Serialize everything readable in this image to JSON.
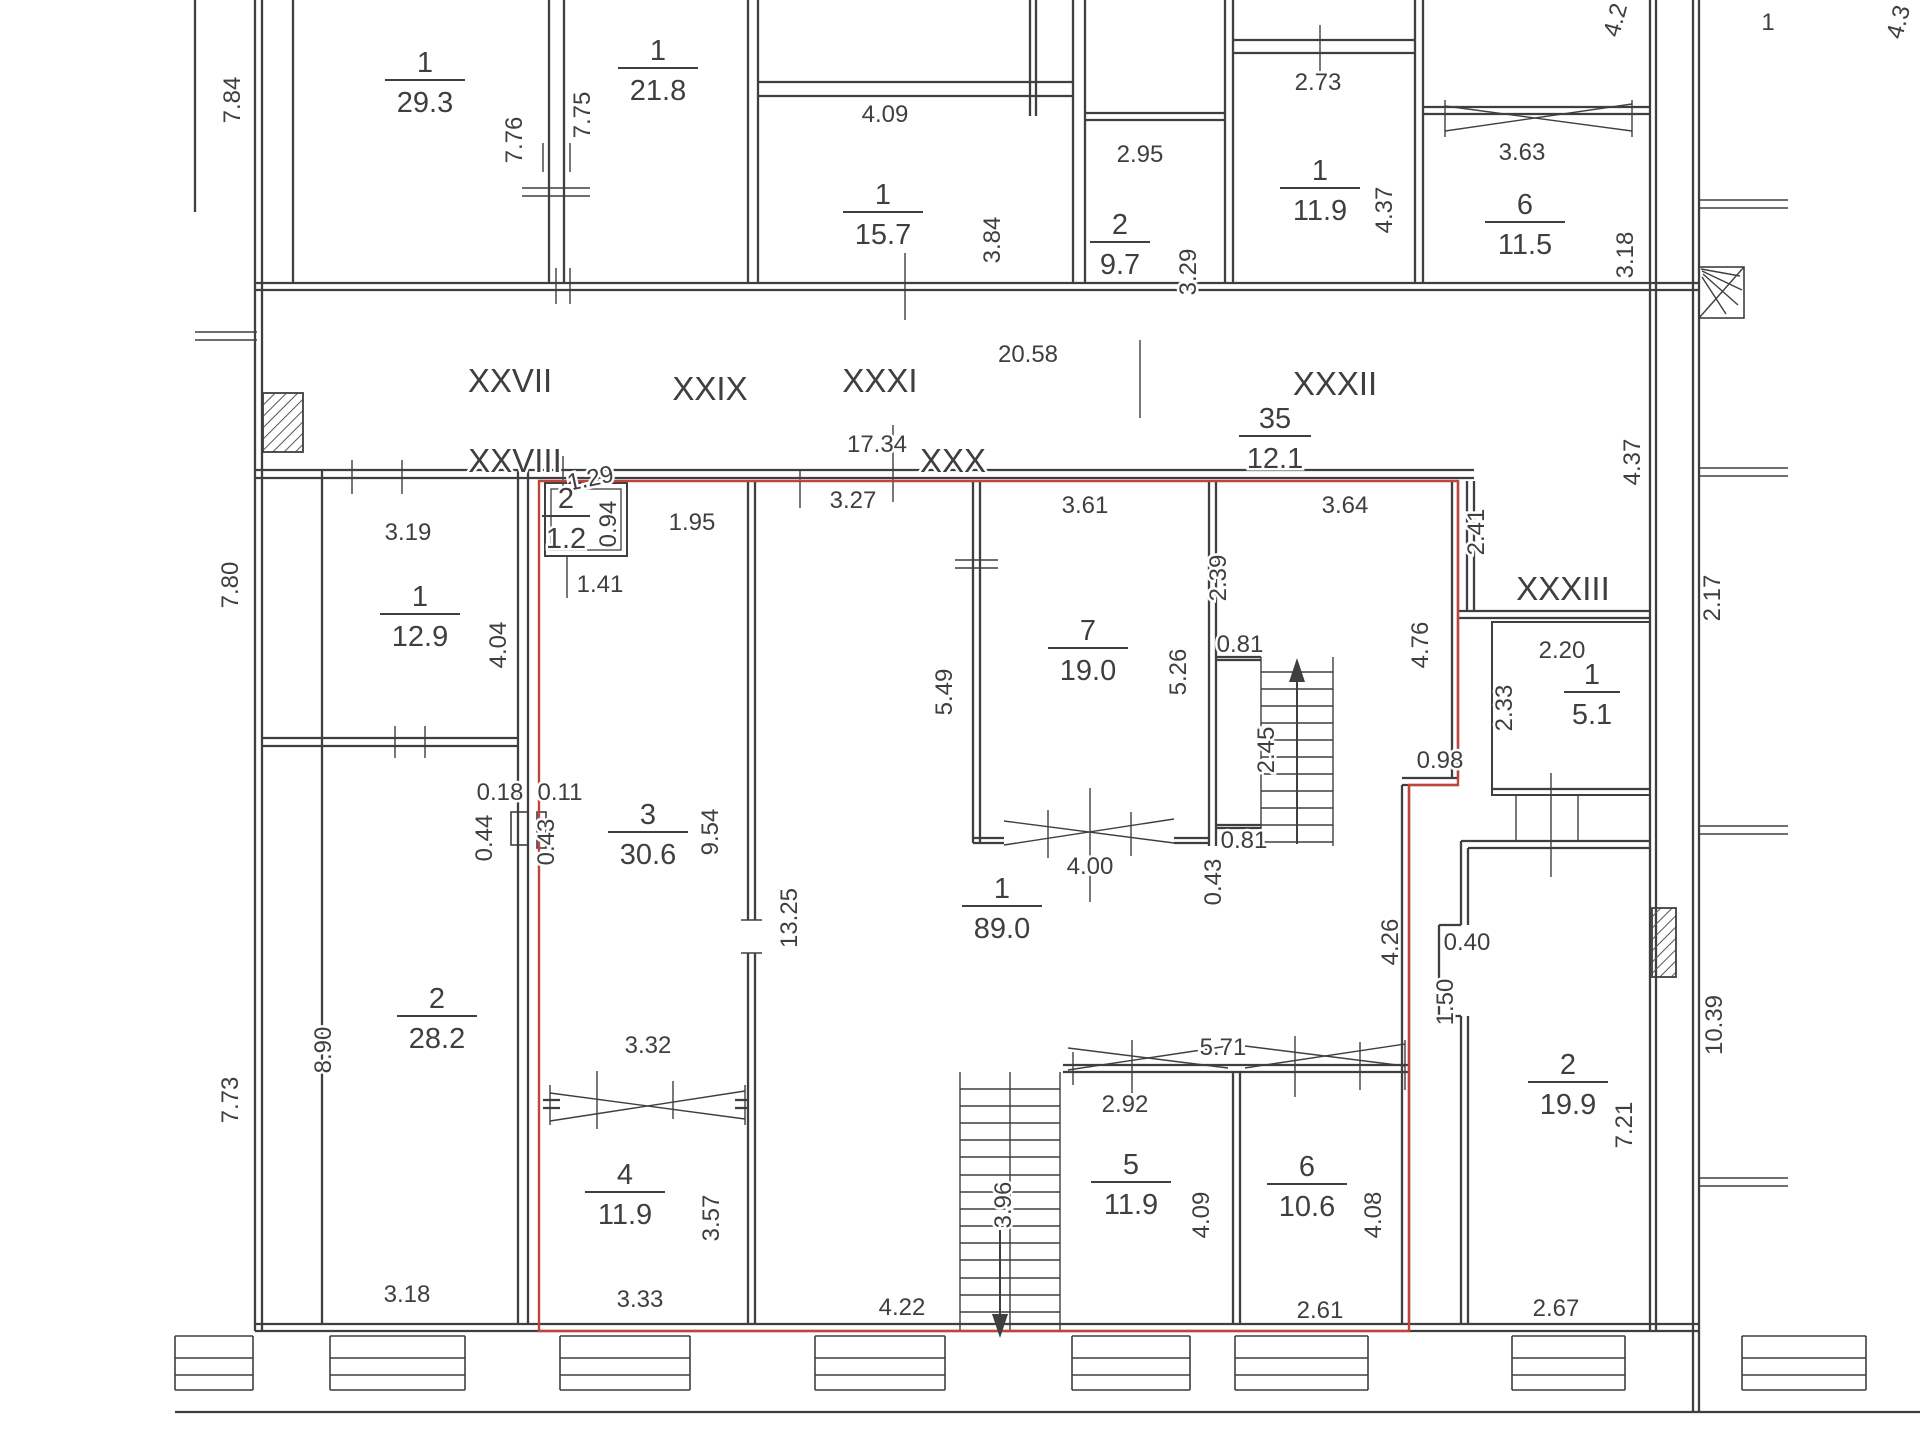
{
  "meta": {
    "title": "Floor plan",
    "ink": "#3f3f3f",
    "red": "#c0443a",
    "background": "#ffffff"
  },
  "rooms": [
    {
      "n": "1",
      "a": "29.3",
      "x": 425,
      "y": 80,
      "w": 40
    },
    {
      "n": "1",
      "a": "21.8",
      "x": 658,
      "y": 68,
      "w": 40
    },
    {
      "n": "1",
      "a": "15.7",
      "x": 883,
      "y": 212,
      "w": 40
    },
    {
      "n": "2",
      "a": "9.7",
      "x": 1120,
      "y": 242,
      "w": 30
    },
    {
      "n": "1",
      "a": "11.9",
      "x": 1320,
      "y": 188,
      "w": 40
    },
    {
      "n": "6",
      "a": "11.5",
      "x": 1525,
      "y": 222,
      "w": 40
    },
    {
      "n": "35",
      "a": "12.1",
      "x": 1275,
      "y": 436,
      "w": 36
    },
    {
      "n": "2",
      "a": "1.2",
      "x": 566,
      "y": 516,
      "w": 24
    },
    {
      "n": "1",
      "a": "12.9",
      "x": 420,
      "y": 614,
      "w": 40
    },
    {
      "n": "7",
      "a": "19.0",
      "x": 1088,
      "y": 648,
      "w": 40
    },
    {
      "n": "1",
      "a": "5.1",
      "x": 1592,
      "y": 692,
      "w": 28
    },
    {
      "n": "3",
      "a": "30.6",
      "x": 648,
      "y": 832,
      "w": 40
    },
    {
      "n": "1",
      "a": "89.0",
      "x": 1002,
      "y": 906,
      "w": 40
    },
    {
      "n": "2",
      "a": "28.2",
      "x": 437,
      "y": 1016,
      "w": 40
    },
    {
      "n": "2",
      "a": "19.9",
      "x": 1568,
      "y": 1082,
      "w": 40
    },
    {
      "n": "4",
      "a": "11.9",
      "x": 625,
      "y": 1192,
      "w": 40
    },
    {
      "n": "5",
      "a": "11.9",
      "x": 1131,
      "y": 1182,
      "w": 40
    },
    {
      "n": "6",
      "a": "10.6",
      "x": 1307,
      "y": 1184,
      "w": 40
    }
  ],
  "labels": [
    {
      "t": "7.84",
      "x": 240,
      "y": 100,
      "r": -90
    },
    {
      "t": "7.76",
      "x": 522,
      "y": 140,
      "r": -90
    },
    {
      "t": "7.75",
      "x": 590,
      "y": 115,
      "r": -90
    },
    {
      "t": "4.09",
      "x": 885,
      "y": 122
    },
    {
      "t": "3.84",
      "x": 1000,
      "y": 240,
      "r": -90
    },
    {
      "t": "2.95",
      "x": 1140,
      "y": 162
    },
    {
      "t": "3.29",
      "x": 1196,
      "y": 272,
      "r": -90
    },
    {
      "t": "2.73",
      "x": 1318,
      "y": 90
    },
    {
      "t": "4.37",
      "x": 1392,
      "y": 210,
      "r": -90
    },
    {
      "t": "3.63",
      "x": 1522,
      "y": 160
    },
    {
      "t": "3.18",
      "x": 1633,
      "y": 255,
      "r": -90
    },
    {
      "t": "4.2",
      "x": 1623,
      "y": 22,
      "r": -75
    },
    {
      "t": "1",
      "x": 1768,
      "y": 30
    },
    {
      "t": "4.3",
      "x": 1906,
      "y": 24,
      "r": -75
    },
    {
      "t": "XXVII",
      "x": 510,
      "y": 392,
      "s": 33
    },
    {
      "t": "XXIX",
      "x": 710,
      "y": 400,
      "s": 33
    },
    {
      "t": "XXXI",
      "x": 880,
      "y": 392,
      "s": 33
    },
    {
      "t": "20.58",
      "x": 1028,
      "y": 362
    },
    {
      "t": "XXXII",
      "x": 1335,
      "y": 395,
      "s": 33
    },
    {
      "t": "XXVIII",
      "x": 515,
      "y": 472,
      "s": 33
    },
    {
      "t": "17.34",
      "x": 877,
      "y": 452
    },
    {
      "t": "XXX",
      "x": 953,
      "y": 472,
      "s": 33
    },
    {
      "t": "XXXIII",
      "x": 1563,
      "y": 600,
      "s": 33
    },
    {
      "t": "3.19",
      "x": 408,
      "y": 540
    },
    {
      "t": "4.04",
      "x": 506,
      "y": 645,
      "r": -90
    },
    {
      "t": "7.80",
      "x": 238,
      "y": 585,
      "r": -90
    },
    {
      "t": "1.29",
      "x": 592,
      "y": 486,
      "r": -12
    },
    {
      "t": "0.94",
      "x": 616,
      "y": 524,
      "r": -90
    },
    {
      "t": "1.41",
      "x": 600,
      "y": 592
    },
    {
      "t": "1.95",
      "x": 692,
      "y": 530
    },
    {
      "t": "3.27",
      "x": 853,
      "y": 508
    },
    {
      "t": "3.61",
      "x": 1085,
      "y": 513
    },
    {
      "t": "3.64",
      "x": 1345,
      "y": 513
    },
    {
      "t": "2.39",
      "x": 1226,
      "y": 578,
      "r": -90
    },
    {
      "t": "5.49",
      "x": 952,
      "y": 692,
      "r": -90
    },
    {
      "t": "5.26",
      "x": 1186,
      "y": 672,
      "r": -90
    },
    {
      "t": "0.81",
      "x": 1240,
      "y": 652
    },
    {
      "t": "2.45",
      "x": 1274,
      "y": 750,
      "r": -90
    },
    {
      "t": "0.81",
      "x": 1244,
      "y": 848
    },
    {
      "t": "4.00",
      "x": 1090,
      "y": 874
    },
    {
      "t": "0.43",
      "x": 1221,
      "y": 882,
      "r": -90
    },
    {
      "t": "2.41",
      "x": 1484,
      "y": 532,
      "r": -90
    },
    {
      "t": "4.76",
      "x": 1428,
      "y": 645,
      "r": -90
    },
    {
      "t": "0.98",
      "x": 1440,
      "y": 768
    },
    {
      "t": "2.20",
      "x": 1562,
      "y": 658
    },
    {
      "t": "2.33",
      "x": 1512,
      "y": 708,
      "r": -90
    },
    {
      "t": "2.17",
      "x": 1720,
      "y": 598,
      "r": -90
    },
    {
      "t": "4.37",
      "x": 1640,
      "y": 462,
      "r": -90
    },
    {
      "t": "0.18",
      "x": 500,
      "y": 800
    },
    {
      "t": "0.11",
      "x": 560,
      "y": 800
    },
    {
      "t": "0.44",
      "x": 492,
      "y": 838,
      "r": -90
    },
    {
      "t": "0.43",
      "x": 554,
      "y": 842,
      "r": -90
    },
    {
      "t": "9.54",
      "x": 718,
      "y": 832,
      "r": -90
    },
    {
      "t": "13.25",
      "x": 797,
      "y": 918,
      "r": -90
    },
    {
      "t": "8.90",
      "x": 331,
      "y": 1050,
      "r": -90
    },
    {
      "t": "7.73",
      "x": 238,
      "y": 1100,
      "r": -90
    },
    {
      "t": "0.40",
      "x": 1467,
      "y": 950
    },
    {
      "t": "1.50",
      "x": 1453,
      "y": 1002,
      "r": -90
    },
    {
      "t": "10.39",
      "x": 1722,
      "y": 1025,
      "r": -90
    },
    {
      "t": "7.21",
      "x": 1632,
      "y": 1125,
      "r": -90
    },
    {
      "t": "4.26",
      "x": 1398,
      "y": 942,
      "r": -90
    },
    {
      "t": "3.32",
      "x": 648,
      "y": 1053
    },
    {
      "t": "3.57",
      "x": 719,
      "y": 1218,
      "r": -90
    },
    {
      "t": "5.71",
      "x": 1223,
      "y": 1055
    },
    {
      "t": "2.92",
      "x": 1125,
      "y": 1112
    },
    {
      "t": "4.09",
      "x": 1209,
      "y": 1215,
      "r": -90
    },
    {
      "t": "4.08",
      "x": 1381,
      "y": 1215,
      "r": -90
    },
    {
      "t": "3.96",
      "x": 1011,
      "y": 1205,
      "r": -90
    },
    {
      "t": "3.18",
      "x": 407,
      "y": 1302
    },
    {
      "t": "3.33",
      "x": 640,
      "y": 1307
    },
    {
      "t": "4.22",
      "x": 902,
      "y": 1315
    },
    {
      "t": "2.61",
      "x": 1320,
      "y": 1318
    },
    {
      "t": "2.67",
      "x": 1556,
      "y": 1316
    }
  ],
  "walls": [
    [
      195,
      0,
      195,
      212
    ],
    [
      255,
      0,
      255,
      1331
    ],
    [
      262,
      0,
      262,
      1331
    ],
    [
      293,
      0,
      293,
      283
    ],
    [
      549,
      0,
      549,
      283
    ],
    [
      564,
      0,
      564,
      283
    ],
    [
      748,
      0,
      748,
      283
    ],
    [
      758,
      0,
      758,
      283
    ],
    [
      1030,
      0,
      1030,
      116
    ],
    [
      1036,
      0,
      1036,
      116
    ],
    [
      1073,
      0,
      1073,
      283
    ],
    [
      1085,
      0,
      1085,
      283
    ],
    [
      1225,
      0,
      1225,
      283
    ],
    [
      1233,
      0,
      1233,
      283
    ],
    [
      1415,
      0,
      1415,
      283
    ],
    [
      1423,
      0,
      1423,
      283
    ],
    [
      1650,
      0,
      1650,
      1331
    ],
    [
      1656,
      0,
      1656,
      1331
    ],
    [
      1693,
      0,
      1693,
      1412
    ],
    [
      1699,
      0,
      1699,
      1412
    ],
    [
      758,
      82,
      1073,
      82
    ],
    [
      758,
      96,
      1073,
      96
    ],
    [
      1085,
      113,
      1225,
      113
    ],
    [
      1085,
      120,
      1225,
      120
    ],
    [
      1233,
      40,
      1415,
      40
    ],
    [
      1233,
      53,
      1415,
      53
    ],
    [
      1423,
      107,
      1650,
      107
    ],
    [
      1423,
      114,
      1650,
      114
    ],
    [
      255,
      283,
      1699,
      283
    ],
    [
      255,
      290,
      1699,
      290
    ],
    [
      255,
      470,
      1474,
      470
    ],
    [
      255,
      478,
      1474,
      478
    ],
    [
      322,
      470,
      322,
      1324
    ],
    [
      518,
      470,
      518,
      1324
    ],
    [
      528,
      470,
      528,
      1324
    ],
    [
      262,
      738,
      518,
      738
    ],
    [
      262,
      746,
      518,
      746
    ],
    [
      255,
      1324,
      1699,
      1324
    ],
    [
      255,
      1331,
      1699,
      1331
    ],
    [
      748,
      481,
      748,
      920
    ],
    [
      748,
      953,
      748,
      1324
    ],
    [
      755,
      481,
      755,
      920
    ],
    [
      755,
      953,
      755,
      1324
    ],
    [
      973,
      481,
      973,
      843
    ],
    [
      980,
      481,
      980,
      843
    ],
    [
      1209,
      481,
      1209,
      846
    ],
    [
      1216,
      481,
      1216,
      846
    ],
    [
      973,
      838,
      1004,
      838
    ],
    [
      973,
      843,
      1004,
      843
    ],
    [
      1174,
      838,
      1209,
      838
    ],
    [
      1174,
      843,
      1209,
      843
    ],
    [
      1216,
      657,
      1261,
      657
    ],
    [
      1216,
      660,
      1261,
      660
    ],
    [
      1216,
      825,
      1261,
      825
    ],
    [
      1216,
      828,
      1261,
      828
    ],
    [
      543,
      1100,
      560,
      1100
    ],
    [
      543,
      1108,
      560,
      1108
    ],
    [
      735,
      1100,
      748,
      1100
    ],
    [
      735,
      1108,
      748,
      1108
    ],
    [
      1063,
      1065,
      1409,
      1065
    ],
    [
      1063,
      1072,
      1409,
      1072
    ],
    [
      1233,
      1072,
      1233,
      1324
    ],
    [
      1240,
      1072,
      1240,
      1324
    ],
    [
      1452,
      481,
      1452,
      778
    ],
    [
      1458,
      481,
      1458,
      778
    ],
    [
      1467,
      481,
      1467,
      611
    ],
    [
      1474,
      481,
      1474,
      611
    ],
    [
      1402,
      778,
      1458,
      778
    ],
    [
      1402,
      785,
      1458,
      785
    ],
    [
      1402,
      785,
      1402,
      1324
    ],
    [
      1409,
      785,
      1409,
      1324
    ],
    [
      1458,
      611,
      1650,
      611
    ],
    [
      1458,
      618,
      1650,
      618
    ],
    [
      1492,
      789,
      1650,
      789
    ],
    [
      1461,
      841,
      1650,
      841
    ],
    [
      1468,
      848,
      1650,
      848
    ],
    [
      1461,
      841,
      1461,
      925
    ],
    [
      1439,
      925,
      1461,
      925
    ],
    [
      1439,
      925,
      1439,
      1016
    ],
    [
      1439,
      1016,
      1461,
      1016
    ],
    [
      1461,
      1016,
      1461,
      1324
    ],
    [
      1468,
      848,
      1468,
      925
    ],
    [
      1468,
      1016,
      1468,
      1324
    ],
    [
      175,
      1412,
      1920,
      1412
    ]
  ],
  "thin": [
    [
      1445,
      131,
      1632,
      104
    ],
    [
      1445,
      106,
      1632,
      131
    ],
    [
      1445,
      100,
      1445,
      137
    ],
    [
      1632,
      100,
      1632,
      137
    ],
    [
      522,
      188,
      590,
      188
    ],
    [
      522,
      196,
      590,
      196
    ],
    [
      543,
      143,
      543,
      172
    ],
    [
      570,
      143,
      570,
      172
    ],
    [
      1320,
      25,
      1320,
      77
    ],
    [
      556,
      268,
      556,
      304
    ],
    [
      570,
      268,
      570,
      304
    ],
    [
      905,
      253,
      905,
      320
    ],
    [
      1140,
      340,
      1140,
      418
    ],
    [
      563,
      456,
      563,
      492
    ],
    [
      800,
      470,
      800,
      508
    ],
    [
      893,
      425,
      893,
      502
    ],
    [
      195,
      332,
      257,
      332
    ],
    [
      195,
      340,
      257,
      340
    ],
    [
      352,
      460,
      352,
      494
    ],
    [
      402,
      460,
      402,
      494
    ],
    [
      395,
      726,
      395,
      758
    ],
    [
      425,
      726,
      425,
      758
    ],
    [
      550,
      1121,
      745,
      1091
    ],
    [
      550,
      1093,
      745,
      1119
    ],
    [
      550,
      1085,
      550,
      1125
    ],
    [
      745,
      1085,
      745,
      1125
    ],
    [
      597,
      1071,
      597,
      1129
    ],
    [
      673,
      1081,
      673,
      1119
    ],
    [
      741,
      920,
      762,
      920
    ],
    [
      741,
      953,
      762,
      953
    ],
    [
      955,
      560,
      998,
      560
    ],
    [
      955,
      568,
      998,
      568
    ],
    [
      1004,
      845,
      1174,
      819
    ],
    [
      1004,
      821,
      1174,
      843
    ],
    [
      1048,
      810,
      1048,
      858
    ],
    [
      1090,
      788,
      1090,
      902
    ],
    [
      1131,
      812,
      1131,
      856
    ],
    [
      1068,
      1070,
      1228,
      1046
    ],
    [
      1068,
      1048,
      1228,
      1068
    ],
    [
      1245,
      1068,
      1405,
      1044
    ],
    [
      1245,
      1046,
      1405,
      1066
    ],
    [
      1132,
      1040,
      1132,
      1093
    ],
    [
      1295,
      1036,
      1295,
      1097
    ],
    [
      1360,
      1042,
      1360,
      1090
    ],
    [
      1073,
      1052,
      1073,
      1085
    ],
    [
      1405,
      1040,
      1405,
      1090
    ],
    [
      567,
      556,
      567,
      598
    ],
    [
      1516,
      795,
      1516,
      841
    ],
    [
      1578,
      795,
      1578,
      841
    ],
    [
      1551,
      773,
      1551,
      877
    ],
    [
      1699,
      200,
      1788,
      200
    ],
    [
      1699,
      208,
      1788,
      208
    ],
    [
      1699,
      468,
      1788,
      468
    ],
    [
      1699,
      476,
      1788,
      476
    ],
    [
      1699,
      826,
      1788,
      826
    ],
    [
      1699,
      834,
      1788,
      834
    ],
    [
      1699,
      1178,
      1788,
      1178
    ],
    [
      1699,
      1186,
      1788,
      1186
    ],
    [
      1699,
      318,
      1744,
      267
    ],
    [
      1701,
      269,
      1740,
      276
    ],
    [
      1702,
      271,
      1742,
      290
    ],
    [
      1703,
      274,
      1738,
      305
    ],
    [
      1702,
      277,
      1726,
      314
    ],
    [
      1261,
      657,
      1261,
      846
    ],
    [
      1333,
      657,
      1333,
      846
    ],
    [
      1261,
      672,
      1333,
      672
    ],
    [
      1261,
      689,
      1333,
      689
    ],
    [
      1261,
      706,
      1333,
      706
    ],
    [
      1261,
      723,
      1333,
      723
    ],
    [
      1261,
      740,
      1333,
      740
    ],
    [
      1261,
      757,
      1333,
      757
    ],
    [
      1261,
      774,
      1333,
      774
    ],
    [
      1261,
      791,
      1333,
      791
    ],
    [
      1261,
      808,
      1333,
      808
    ],
    [
      1261,
      825,
      1333,
      825
    ],
    [
      1261,
      842,
      1333,
      842
    ],
    [
      960,
      1072,
      960,
      1330
    ],
    [
      1010,
      1072,
      1010,
      1330
    ],
    [
      1060,
      1072,
      1060,
      1330
    ],
    [
      960,
      1089,
      1060,
      1089
    ],
    [
      960,
      1106,
      1060,
      1106
    ],
    [
      960,
      1123,
      1060,
      1123
    ],
    [
      960,
      1140,
      1060,
      1140
    ],
    [
      960,
      1157,
      1060,
      1157
    ],
    [
      960,
      1175,
      1060,
      1175
    ],
    [
      960,
      1192,
      1060,
      1192
    ],
    [
      960,
      1209,
      1060,
      1209
    ],
    [
      960,
      1226,
      1060,
      1226
    ],
    [
      960,
      1243,
      1060,
      1243
    ],
    [
      960,
      1260,
      1060,
      1260
    ],
    [
      960,
      1278,
      1060,
      1278
    ],
    [
      960,
      1295,
      1060,
      1295
    ],
    [
      960,
      1312,
      1060,
      1312
    ]
  ],
  "rects": [
    [
      545,
      483,
      82,
      73,
      2
    ],
    [
      551,
      489,
      70,
      61,
      1.3
    ],
    [
      511,
      812,
      17,
      33,
      1.6
    ],
    [
      537,
      812,
      9,
      36,
      1.6
    ],
    [
      1492,
      622,
      158,
      173,
      2
    ],
    [
      1699,
      267,
      45,
      51,
      1.6
    ]
  ],
  "hatch_rects": [
    [
      263,
      393,
      40,
      59
    ],
    [
      1652,
      908,
      24,
      69
    ]
  ],
  "sill_bays": [
    [
      175,
      253
    ],
    [
      330,
      465
    ],
    [
      560,
      690
    ],
    [
      815,
      945
    ],
    [
      1072,
      1190
    ],
    [
      1235,
      1368
    ],
    [
      1512,
      1625
    ],
    [
      1742,
      1866
    ]
  ],
  "sill_rows": [
    1336,
    1358,
    1375,
    1390
  ],
  "red_path": "M539,481 L1458,481 L1458,785 L1409,785 L1409,1331 L539,1331 Z",
  "arrows": [
    {
      "stem": [
        1297,
        680,
        1297,
        844
      ],
      "head": "1297,658 1289,682 1305,682"
    },
    {
      "stem": [
        1000,
        1230,
        1000,
        1320
      ],
      "head": "1000,1338 992,1314 1008,1314"
    }
  ]
}
